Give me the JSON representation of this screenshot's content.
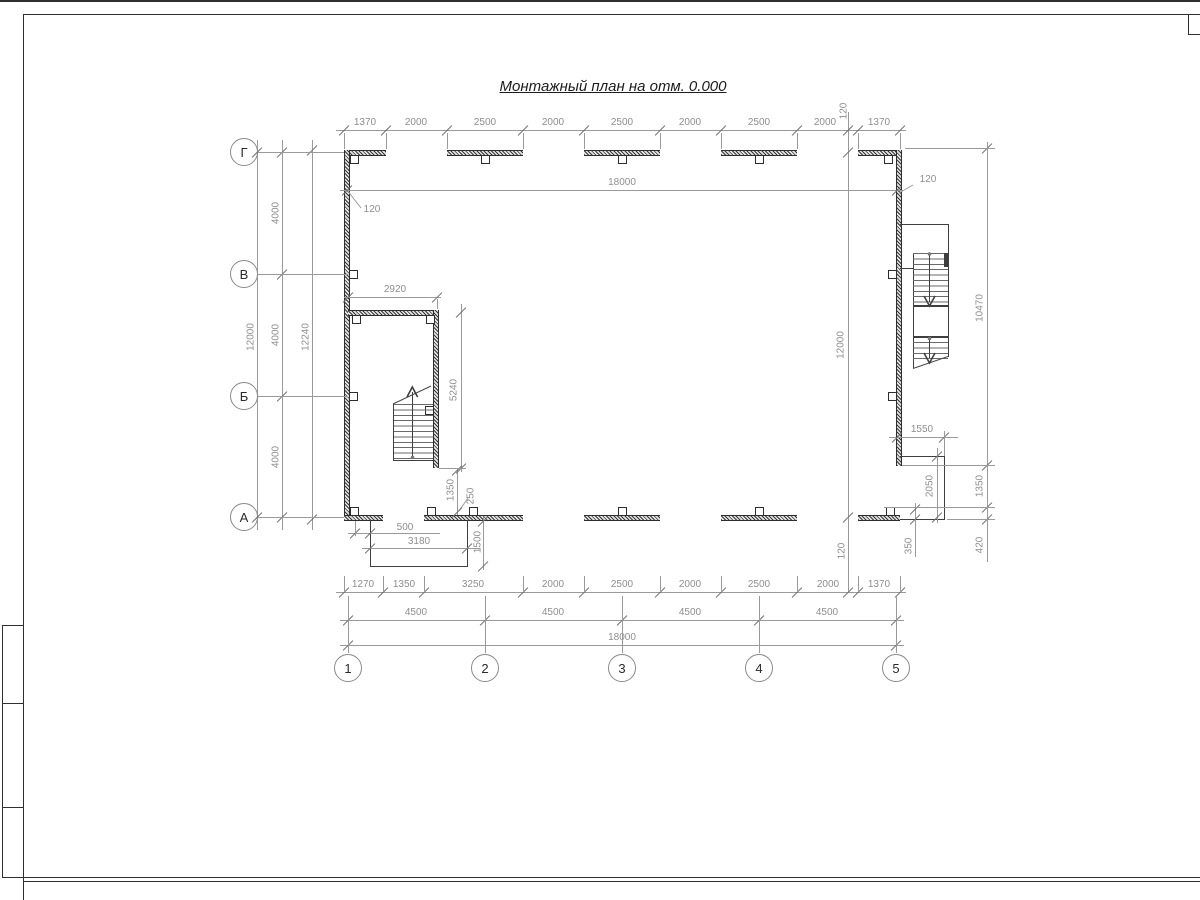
{
  "title": "Монтажный план на отм. 0.000",
  "axes": {
    "rows": [
      "Г",
      "В",
      "Б",
      "А"
    ],
    "cols": [
      "1",
      "2",
      "3",
      "4",
      "5"
    ]
  },
  "dims": {
    "top_row": [
      "1370",
      "2000",
      "2500",
      "2000",
      "2500",
      "2000",
      "2500",
      "2000",
      "1370"
    ],
    "top_overall": "18000",
    "top_overall_offset": "120",
    "wall_leader_left": "120",
    "left_overall": "12000",
    "left_bays": [
      "4000",
      "4000",
      "4000"
    ],
    "left_outer": "12240",
    "stair1_width": "2920",
    "stair1_wall": "5240",
    "stair1_gap": "1350",
    "stair1_door": "250",
    "porch1_offset": "500",
    "porch1_width": "3180",
    "porch1_depth": "1500",
    "inner_v_line": {
      "top_offset": "120",
      "height": "12000",
      "bottom_offset": "120"
    },
    "right_overall": "10470",
    "right_seg1": "1350",
    "right_seg2": "420",
    "porch2_width": "1550",
    "porch2_depth": "2050",
    "porch2_offset": "350",
    "bottom_row1": [
      "1270",
      "1350",
      "3250",
      "2000",
      "2500",
      "2000",
      "2500",
      "2000",
      "1370"
    ],
    "bottom_row2": [
      "4500",
      "4500",
      "4500",
      "4500"
    ],
    "bottom_overall": "18000"
  }
}
